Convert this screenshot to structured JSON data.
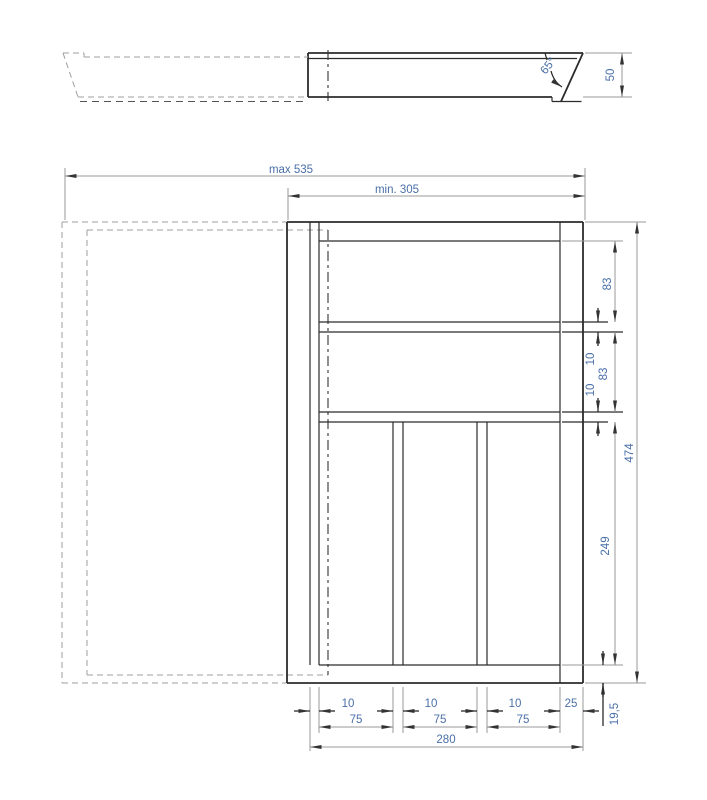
{
  "side_view": {
    "angle": "65°",
    "height": "50"
  },
  "plan_view": {
    "max_width": "max 535",
    "min_width": "min. 305",
    "right": {
      "comp1_height": "83",
      "gap1": "10",
      "comp2_height": "83",
      "gap2": "10",
      "bottom_section_height": "249",
      "total_height": "474",
      "bottom_wall": "19,5"
    },
    "bottom": {
      "gaps": [
        "10",
        "10",
        "10"
      ],
      "slots": [
        "75",
        "75",
        "75"
      ],
      "right_wall": "25",
      "body_width": "280"
    }
  },
  "colors": {
    "object_line": "#2b2b2b",
    "dim_line": "#9a9a9a",
    "dim_text": "#4a6fa8"
  }
}
